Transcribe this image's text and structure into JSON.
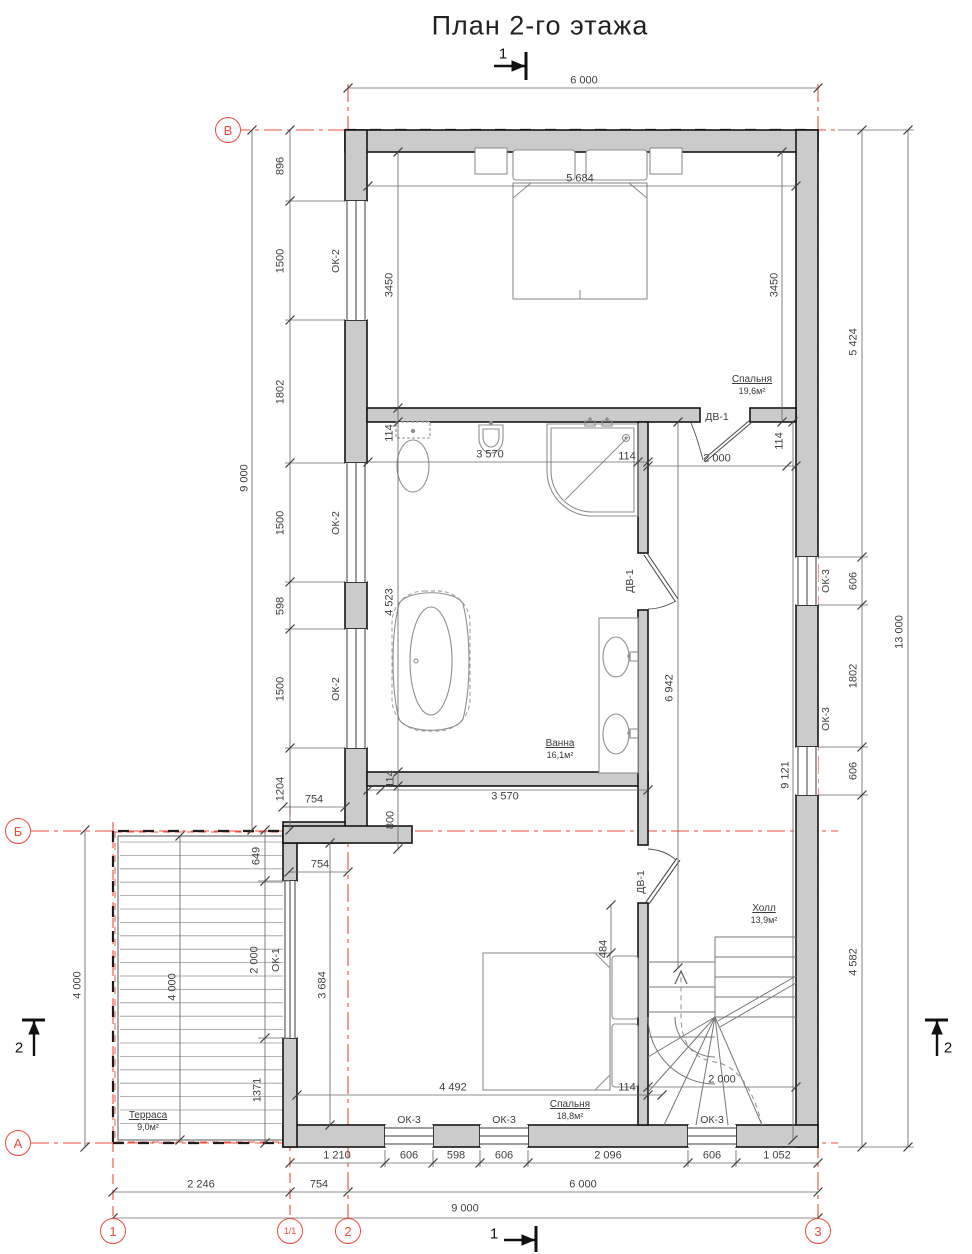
{
  "title": "План 2-го этажа",
  "axes": {
    "v": "В",
    "b": "Б",
    "a": "А",
    "n1": "1",
    "n11": "1/1",
    "n2": "2",
    "n3": "3"
  },
  "sections": {
    "s1": "1",
    "s2": "2"
  },
  "rooms": {
    "bedroom_top": {
      "name": "Спальня",
      "area": "19,6м²"
    },
    "bathroom": {
      "name": "Ванна",
      "area": "16,1м²"
    },
    "hall": {
      "name": "Холл",
      "area": "13,9м²"
    },
    "bedroom_bottom": {
      "name": "Спальня",
      "area": "18,8м²"
    },
    "terrace": {
      "name": "Терраса",
      "area": "9,0м²"
    }
  },
  "openings": {
    "ok1": "ОК-1",
    "ok2": "ОК-2",
    "ok3": "ОК-3",
    "dv1": "ДВ-1"
  },
  "dims": {
    "d6000": "6 000",
    "d9000": "9 000",
    "d13000": "13 000",
    "d5684": "5 684",
    "d3450": "3450",
    "d896": "896",
    "d1500": "1500",
    "d1802": "1802",
    "d598": "598",
    "d1204": "1204",
    "d5424": "5 424",
    "d606": "606",
    "d9121": "9 121",
    "d4582": "4 582",
    "d114": "114",
    "d3570": "3 570",
    "d4523": "4 523",
    "d6942": "6 942",
    "d800": "800",
    "d2000": "2 000",
    "d754": "754",
    "d649": "649",
    "d4000": "4 000",
    "d1371": "1371",
    "d3684": "3 684",
    "d4492": "4 492",
    "d484": "484",
    "d1210": "1 210",
    "d2096": "2 096",
    "d1052": "1 052",
    "d2246": "2 246"
  },
  "colors": {
    "axis_red": "#ee4d3b",
    "wall_fill": "#cbcbcb",
    "line": "#5a5a5a"
  }
}
